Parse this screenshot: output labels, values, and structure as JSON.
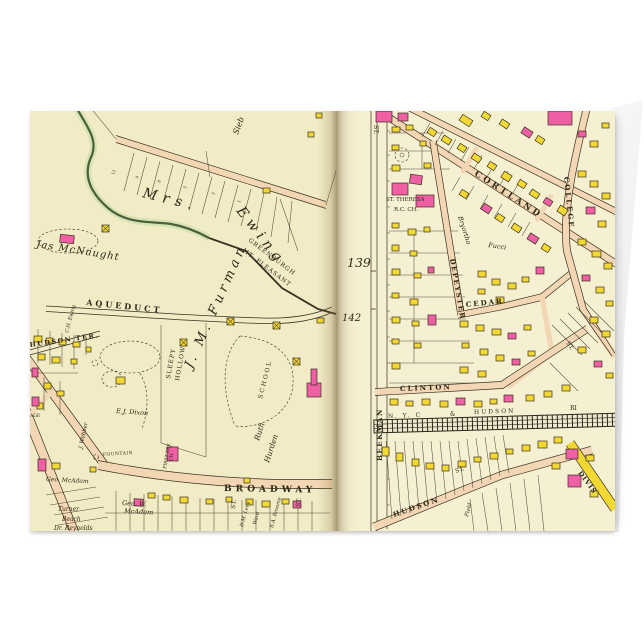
{
  "card": {
    "page_background": "#ffffff",
    "description": "folded greeting card standing, antique street-atlas print on front"
  },
  "map": {
    "colors": {
      "paper_left": "#f1ebc6",
      "paper_right": "#f6f0d2",
      "road": "#f3d7b4",
      "yellow": "#f2d832",
      "pink": "#ee5fa3",
      "line": "#3a3121",
      "ink": "#2f2817",
      "stream": "#49603a",
      "stream_wash": "#d3e2b0",
      "rail": "#2c261b",
      "gutter_shadow": "#5d4a26"
    },
    "left_page": {
      "page_ref": "142",
      "lot_numbers": [
        "11",
        "9",
        "8",
        "5",
        "2",
        "1"
      ],
      "labels": {
        "sieb": "Sieb",
        "mrs": "Mrs.",
        "ewing": "Ewing",
        "jas_mcnaught": "Jas McNaught",
        "greenburgh": "GREENBURGH",
        "mt_pleasant": "MT. PLEASANT",
        "aqueduct": "AQUEDUCT",
        "hudson_ter": "HUDSON TER.",
        "ch_ewing": "C.H. Ewing",
        "age": "AGE",
        "dixon": "E.J. Dixon",
        "webber": "J. Webber",
        "sleepy": "SLEEPY",
        "hollow": "HOLLOW",
        "furman": "J. M. Furman",
        "school": "SCHOOL",
        "ruth": "Ruth",
        "hurden": "Hurden",
        "first_ref": "FIRST REF.",
        "first_ref2": "CH.",
        "fountain": "FOUNTAIN",
        "broadway": "BROADWAY",
        "geo_mcadam": "Geo. McAdam",
        "geo_w": "Geo. W.",
        "mcadam2": "McAdam",
        "turner": "Turner",
        "beach": "Beach",
        "reynolds": "Dr. Reynolds",
        "st1": "ST.",
        "levy": "D.M. Levy",
        "ward": "Ward",
        "broome": "S.A. Broome",
        "st2": "ST."
      }
    },
    "right_page": {
      "page_ref": "139",
      "labels": {
        "st_top": "ST.",
        "theresa1": "ST. THERESA",
        "theresa2": "R.C. CH.",
        "cortland": "CORTLAND",
        "bryortha": "Bryortha",
        "depeyster": "DEPEYSTER",
        "college": "COLLEGE",
        "fucci": "Fucci",
        "cedar": "CEDAR",
        "clinton": "CLINTON",
        "beekman": "BEEKMAN",
        "rr1": "N. Y. C",
        "rr2": "&",
        "rr3": "HUDSON",
        "rr4": "RI",
        "hudson": "HUDSON",
        "hudson_st": "ST.",
        "field": "Field",
        "division": "DIVIS",
        "st_mid": "ST."
      }
    },
    "buildings": [
      [
        233,
        77,
        7,
        5,
        "y",
        0
      ],
      [
        278,
        21,
        6,
        5,
        "y",
        0
      ],
      [
        286,
        2,
        6,
        5,
        "y",
        0
      ],
      [
        30,
        124,
        14,
        8,
        "p",
        6
      ],
      [
        4,
        225,
        8,
        6,
        "y",
        0
      ],
      [
        16,
        227,
        7,
        5,
        "y",
        0
      ],
      [
        29,
        229,
        7,
        5,
        "y",
        0
      ],
      [
        43,
        231,
        7,
        5,
        "y",
        0
      ],
      [
        8,
        243,
        7,
        6,
        "y",
        0
      ],
      [
        22,
        246,
        8,
        6,
        "y",
        0
      ],
      [
        2,
        257,
        6,
        9,
        "p",
        0
      ],
      [
        41,
        248,
        6,
        5,
        "y",
        0
      ],
      [
        56,
        236,
        5,
        5,
        "y",
        0
      ],
      [
        86,
        266,
        9,
        7,
        "y",
        0
      ],
      [
        14,
        272,
        7,
        6,
        "y",
        0
      ],
      [
        27,
        280,
        7,
        5,
        "y",
        0
      ],
      [
        7,
        292,
        6,
        6,
        "y",
        0
      ],
      [
        2,
        286,
        7,
        9,
        "p",
        0
      ],
      [
        8,
        348,
        8,
        12,
        "p",
        0
      ],
      [
        22,
        352,
        8,
        6,
        "y",
        0
      ],
      [
        60,
        356,
        6,
        5,
        "y",
        0
      ],
      [
        104,
        388,
        9,
        7,
        "p",
        3
      ],
      [
        118,
        382,
        7,
        5,
        "y",
        0
      ],
      [
        133,
        384,
        7,
        5,
        "y",
        0
      ],
      [
        150,
        386,
        8,
        6,
        "y",
        0
      ],
      [
        176,
        388,
        7,
        5,
        "y",
        0
      ],
      [
        196,
        386,
        6,
        5,
        "y",
        0
      ],
      [
        216,
        388,
        7,
        6,
        "y",
        0
      ],
      [
        232,
        390,
        8,
        6,
        "y",
        0
      ],
      [
        252,
        388,
        7,
        5,
        "y",
        0
      ],
      [
        263,
        390,
        8,
        7,
        "p",
        0
      ],
      [
        287,
        207,
        7,
        5,
        "y",
        0
      ],
      [
        214,
        367,
        6,
        5,
        "y",
        0
      ],
      [
        137,
        336,
        11,
        14,
        "p",
        0
      ],
      [
        277,
        272,
        14,
        14,
        "p",
        0
      ],
      [
        281,
        258,
        6,
        16,
        "p",
        0
      ],
      [
        346,
        0,
        16,
        11,
        "p",
        0
      ],
      [
        368,
        2,
        10,
        8,
        "p",
        0
      ],
      [
        430,
        6,
        12,
        7,
        "y",
        33
      ],
      [
        452,
        2,
        8,
        6,
        "y",
        33
      ],
      [
        470,
        10,
        9,
        6,
        "y",
        33
      ],
      [
        492,
        18,
        10,
        7,
        "p",
        33
      ],
      [
        506,
        26,
        8,
        6,
        "y",
        33
      ],
      [
        518,
        0,
        24,
        14,
        "p",
        0
      ],
      [
        548,
        20,
        8,
        6,
        "p",
        0
      ],
      [
        560,
        30,
        8,
        6,
        "y",
        0
      ],
      [
        572,
        12,
        7,
        5,
        "y",
        0
      ],
      [
        398,
        18,
        8,
        6,
        "y",
        33
      ],
      [
        412,
        26,
        9,
        6,
        "y",
        33
      ],
      [
        428,
        34,
        8,
        6,
        "y",
        33
      ],
      [
        442,
        44,
        9,
        6,
        "y",
        33
      ],
      [
        458,
        52,
        8,
        6,
        "y",
        33
      ],
      [
        472,
        62,
        9,
        7,
        "y",
        33
      ],
      [
        488,
        70,
        8,
        6,
        "y",
        33
      ],
      [
        500,
        80,
        9,
        6,
        "y",
        33
      ],
      [
        514,
        88,
        8,
        6,
        "p",
        33
      ],
      [
        528,
        96,
        9,
        7,
        "y",
        33
      ],
      [
        430,
        80,
        8,
        6,
        "y",
        33
      ],
      [
        452,
        94,
        9,
        7,
        "p",
        33
      ],
      [
        466,
        104,
        8,
        6,
        "y",
        33
      ],
      [
        482,
        114,
        9,
        6,
        "y",
        33
      ],
      [
        498,
        124,
        10,
        7,
        "p",
        33
      ],
      [
        512,
        134,
        8,
        6,
        "y",
        33
      ],
      [
        362,
        16,
        8,
        5,
        "y",
        0
      ],
      [
        376,
        14,
        7,
        5,
        "y",
        0
      ],
      [
        362,
        34,
        7,
        5,
        "y",
        0
      ],
      [
        390,
        30,
        6,
        5,
        "y",
        0
      ],
      [
        362,
        54,
        8,
        6,
        "y",
        0
      ],
      [
        394,
        52,
        7,
        5,
        "y",
        0
      ],
      [
        362,
        112,
        7,
        5,
        "y",
        0
      ],
      [
        378,
        118,
        8,
        6,
        "y",
        0
      ],
      [
        394,
        116,
        6,
        5,
        "y",
        0
      ],
      [
        362,
        134,
        7,
        6,
        "y",
        0
      ],
      [
        380,
        140,
        7,
        5,
        "y",
        0
      ],
      [
        362,
        158,
        8,
        6,
        "y",
        0
      ],
      [
        384,
        162,
        7,
        5,
        "y",
        0
      ],
      [
        398,
        156,
        6,
        6,
        "p",
        0
      ],
      [
        362,
        182,
        7,
        5,
        "y",
        0
      ],
      [
        380,
        188,
        8,
        6,
        "y",
        0
      ],
      [
        362,
        206,
        8,
        6,
        "y",
        0
      ],
      [
        382,
        210,
        7,
        5,
        "y",
        0
      ],
      [
        398,
        204,
        8,
        10,
        "p",
        0
      ],
      [
        362,
        228,
        7,
        5,
        "y",
        0
      ],
      [
        384,
        232,
        7,
        5,
        "y",
        0
      ],
      [
        362,
        252,
        8,
        6,
        "y",
        0
      ],
      [
        448,
        160,
        8,
        6,
        "y",
        0
      ],
      [
        462,
        168,
        8,
        6,
        "y",
        0
      ],
      [
        478,
        172,
        8,
        6,
        "y",
        0
      ],
      [
        492,
        166,
        7,
        5,
        "y",
        0
      ],
      [
        506,
        156,
        8,
        7,
        "p",
        0
      ],
      [
        448,
        178,
        7,
        5,
        "y",
        0
      ],
      [
        466,
        186,
        8,
        6,
        "y",
        0
      ],
      [
        430,
        210,
        8,
        6,
        "y",
        0
      ],
      [
        446,
        214,
        8,
        6,
        "y",
        0
      ],
      [
        462,
        218,
        9,
        6,
        "y",
        0
      ],
      [
        478,
        222,
        8,
        6,
        "p",
        0
      ],
      [
        494,
        214,
        7,
        5,
        "y",
        0
      ],
      [
        432,
        232,
        7,
        5,
        "y",
        0
      ],
      [
        450,
        238,
        8,
        6,
        "y",
        0
      ],
      [
        466,
        244,
        8,
        6,
        "y",
        0
      ],
      [
        482,
        248,
        8,
        6,
        "p",
        0
      ],
      [
        498,
        240,
        7,
        5,
        "y",
        0
      ],
      [
        430,
        256,
        8,
        6,
        "y",
        0
      ],
      [
        448,
        260,
        8,
        6,
        "y",
        0
      ],
      [
        360,
        288,
        8,
        6,
        "y",
        0
      ],
      [
        376,
        290,
        7,
        5,
        "y",
        0
      ],
      [
        392,
        288,
        8,
        6,
        "y",
        0
      ],
      [
        410,
        290,
        8,
        6,
        "y",
        0
      ],
      [
        426,
        287,
        9,
        7,
        "p",
        0
      ],
      [
        444,
        290,
        8,
        6,
        "y",
        0
      ],
      [
        460,
        288,
        7,
        5,
        "y",
        0
      ],
      [
        474,
        284,
        9,
        7,
        "p",
        0
      ],
      [
        496,
        284,
        8,
        6,
        "y",
        0
      ],
      [
        514,
        280,
        8,
        6,
        "y",
        0
      ],
      [
        532,
        274,
        8,
        6,
        "y",
        0
      ],
      [
        352,
        336,
        7,
        9,
        "y",
        0
      ],
      [
        366,
        342,
        7,
        8,
        "y",
        0
      ],
      [
        382,
        348,
        7,
        7,
        "y",
        0
      ],
      [
        396,
        352,
        8,
        6,
        "y",
        0
      ],
      [
        412,
        354,
        7,
        6,
        "y",
        0
      ],
      [
        428,
        350,
        8,
        6,
        "y",
        0
      ],
      [
        444,
        346,
        7,
        5,
        "y",
        0
      ],
      [
        460,
        342,
        8,
        6,
        "y",
        0
      ],
      [
        476,
        338,
        7,
        5,
        "y",
        0
      ],
      [
        492,
        334,
        8,
        6,
        "y",
        0
      ],
      [
        508,
        330,
        9,
        7,
        "y",
        0
      ],
      [
        524,
        326,
        8,
        6,
        "y",
        0
      ],
      [
        536,
        338,
        12,
        10,
        "p",
        0
      ],
      [
        538,
        364,
        13,
        12,
        "p",
        0
      ],
      [
        556,
        344,
        8,
        6,
        "y",
        0
      ],
      [
        560,
        380,
        8,
        6,
        "y",
        0
      ],
      [
        522,
        352,
        8,
        6,
        "y",
        0
      ],
      [
        548,
        60,
        8,
        6,
        "y",
        0
      ],
      [
        560,
        70,
        8,
        6,
        "y",
        0
      ],
      [
        572,
        82,
        8,
        6,
        "y",
        0
      ],
      [
        556,
        96,
        9,
        7,
        "p",
        0
      ],
      [
        568,
        110,
        8,
        6,
        "y",
        0
      ],
      [
        548,
        128,
        8,
        6,
        "y",
        0
      ],
      [
        562,
        140,
        9,
        6,
        "y",
        0
      ],
      [
        574,
        152,
        8,
        6,
        "y",
        0
      ],
      [
        552,
        164,
        8,
        6,
        "p",
        0
      ],
      [
        566,
        176,
        8,
        6,
        "y",
        0
      ],
      [
        576,
        190,
        7,
        5,
        "y",
        0
      ],
      [
        560,
        206,
        8,
        6,
        "y",
        0
      ],
      [
        572,
        220,
        8,
        6,
        "y",
        0
      ],
      [
        548,
        236,
        8,
        6,
        "y",
        0
      ],
      [
        564,
        250,
        8,
        6,
        "p",
        0
      ],
      [
        576,
        262,
        7,
        5,
        "y",
        0
      ]
    ]
  }
}
